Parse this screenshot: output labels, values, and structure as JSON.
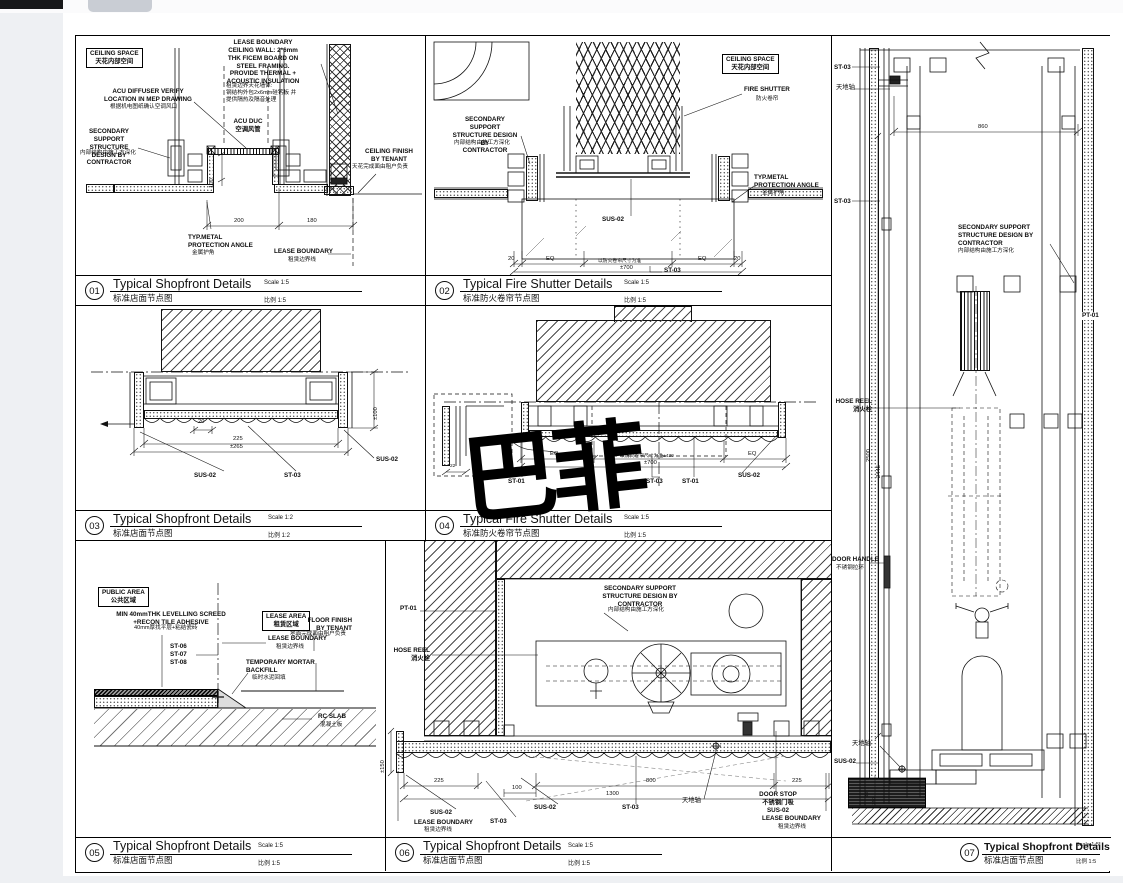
{
  "watermark": "巴菲",
  "shared": {
    "sus02": "SUS-02",
    "st03": "ST-03",
    "st01": "ST-01",
    "pt01": "PT-01",
    "eq": "EQ",
    "ceiling_space": "CEILING SPACE\n天花内部空间",
    "secondary": "SECONDARY SUPPORT\nSTRUCTURE DESIGN BY\nCONTRACTOR",
    "secondary_cn": "内部结构由施工方深化",
    "lease_boundary": "LEASE BOUNDARY",
    "lease_boundary_cn": "租赁边界线",
    "typ_metal": "TYP.METAL\nPROTECTION ANGLE",
    "typ_metal_cn": "金属护角",
    "hose_reel": "HOSE REEL\n消火栓",
    "pivot": "天地轴"
  },
  "panels": {
    "p1": {
      "num": "01",
      "title": "Typical Shopfront Details",
      "title_cn": "标准店面节点图",
      "scale": "Scale 1:5",
      "scale_cn": "比例 1:5",
      "labels": {
        "lease_wall": "LEASE BOUNDARY\nCEILING WALL: 2*6mm\nTHK FICEM BOARD ON\nSTEEL FRAMING.\nPROVIDE THERMAL +\nACOUSTIC INSULATION",
        "lease_wall_cn": "租赁边界天花墙体:\n钢结构外包2x6mm硅钙板 并\n提供隔热及隔音处理",
        "acu_diffuser": "ACU DIFFUSER VERIFY\nLOCATION IN MEP DRAWING",
        "acu_diffuser_cn": "根据机电图纸确认空调风口",
        "acu_duct": "ACU DUC\n空调风管",
        "ceiling_finish": "CEILING FINISH\nBY TENANT",
        "ceiling_finish_cn": "天花完成面由租户负责",
        "dim_200": "200",
        "dim_180": "180",
        "dim_100": "100"
      }
    },
    "p2": {
      "num": "02",
      "title": "Typical Fire Shutter Details",
      "title_cn": "标准防火卷帘节点图",
      "scale": "Scale 1:5",
      "scale_cn": "比例 1:5",
      "labels": {
        "fire_shutter": "FIRE SHUTTER",
        "fire_shutter_cn": "防火卷帘",
        "dim_20l": "20",
        "dim_20r": "20",
        "dim_mid": "以防火卷帘尺寸为准",
        "dim_total": "±700"
      }
    },
    "p3": {
      "num": "03",
      "title": "Typical Shopfront Details",
      "title_cn": "标准店面节点图",
      "scale": "Scale 1:2",
      "scale_cn": "比例 1:2",
      "labels": {
        "dim_20": "20",
        "dim_225": "225",
        "dim_265": "±265",
        "dim_100": "±100"
      }
    },
    "p4": {
      "num": "04",
      "title": "Typical Fire Shutter Details",
      "title_cn": "标准防火卷帘节点图",
      "scale": "Scale 1:5",
      "scale_cn": "比例 1:5",
      "labels": {
        "dim_mid": "以防火卷帘尺寸为准±430",
        "dim_total": "±700",
        "inset_dim": "22"
      }
    },
    "p5": {
      "num": "05",
      "title": "Typical Shopfront Details",
      "title_cn": "标准店面节点图",
      "scale": "Scale 1:5",
      "scale_cn": "比例 1:5",
      "labels": {
        "public_area": "PUBLIC AREA\n公共区域",
        "lease_area": "LEASE AREA\n租赁区域",
        "screed": "MIN 40mmTHK LEVELLING SCREED\n+RECON TILE ADHESIVE",
        "screed_cn": "40mm厚找平层+粘结瓷砖",
        "st_list": "ST-06\nST-07\nST-08",
        "mortar": "TEMPORARY MORTAR\nBACKFILL",
        "mortar_cn": "临时水泥回填",
        "floor_finish": "FLOOR FINISH\nBY TENANT",
        "floor_finish_cn": "地面完成面由租户负责",
        "rc_slab": "RC SLAB",
        "rc_slab_cn": "混凝土板"
      }
    },
    "p6": {
      "num": "06",
      "title": "Typical Shopfront Details",
      "title_cn": "标准店面节点图",
      "scale": "Scale 1:5",
      "scale_cn": "比例 1:5",
      "labels": {
        "door_stop": "DOOR STOP\n不锈钢门吸\nSUS-02",
        "dim_225l": "225",
        "dim_100": "100",
        "dim_800": "800",
        "dim_225r": "225",
        "dim_1300": "1300",
        "dim_150": "±150"
      }
    },
    "p7": {
      "num": "07",
      "title": "Typical Shopfront Details",
      "title_cn": "标准店面节点图",
      "scale": "Scale 1:5",
      "scale_cn": "比例 1:5",
      "labels": {
        "door_handle": "DOOR HANDLE",
        "door_handle_cn": "不锈钢拉环",
        "dim_860": "860",
        "dim_2500": "2500",
        "dim_2445": "2445",
        "dim_40": "40",
        "dim_150": "150"
      }
    }
  }
}
